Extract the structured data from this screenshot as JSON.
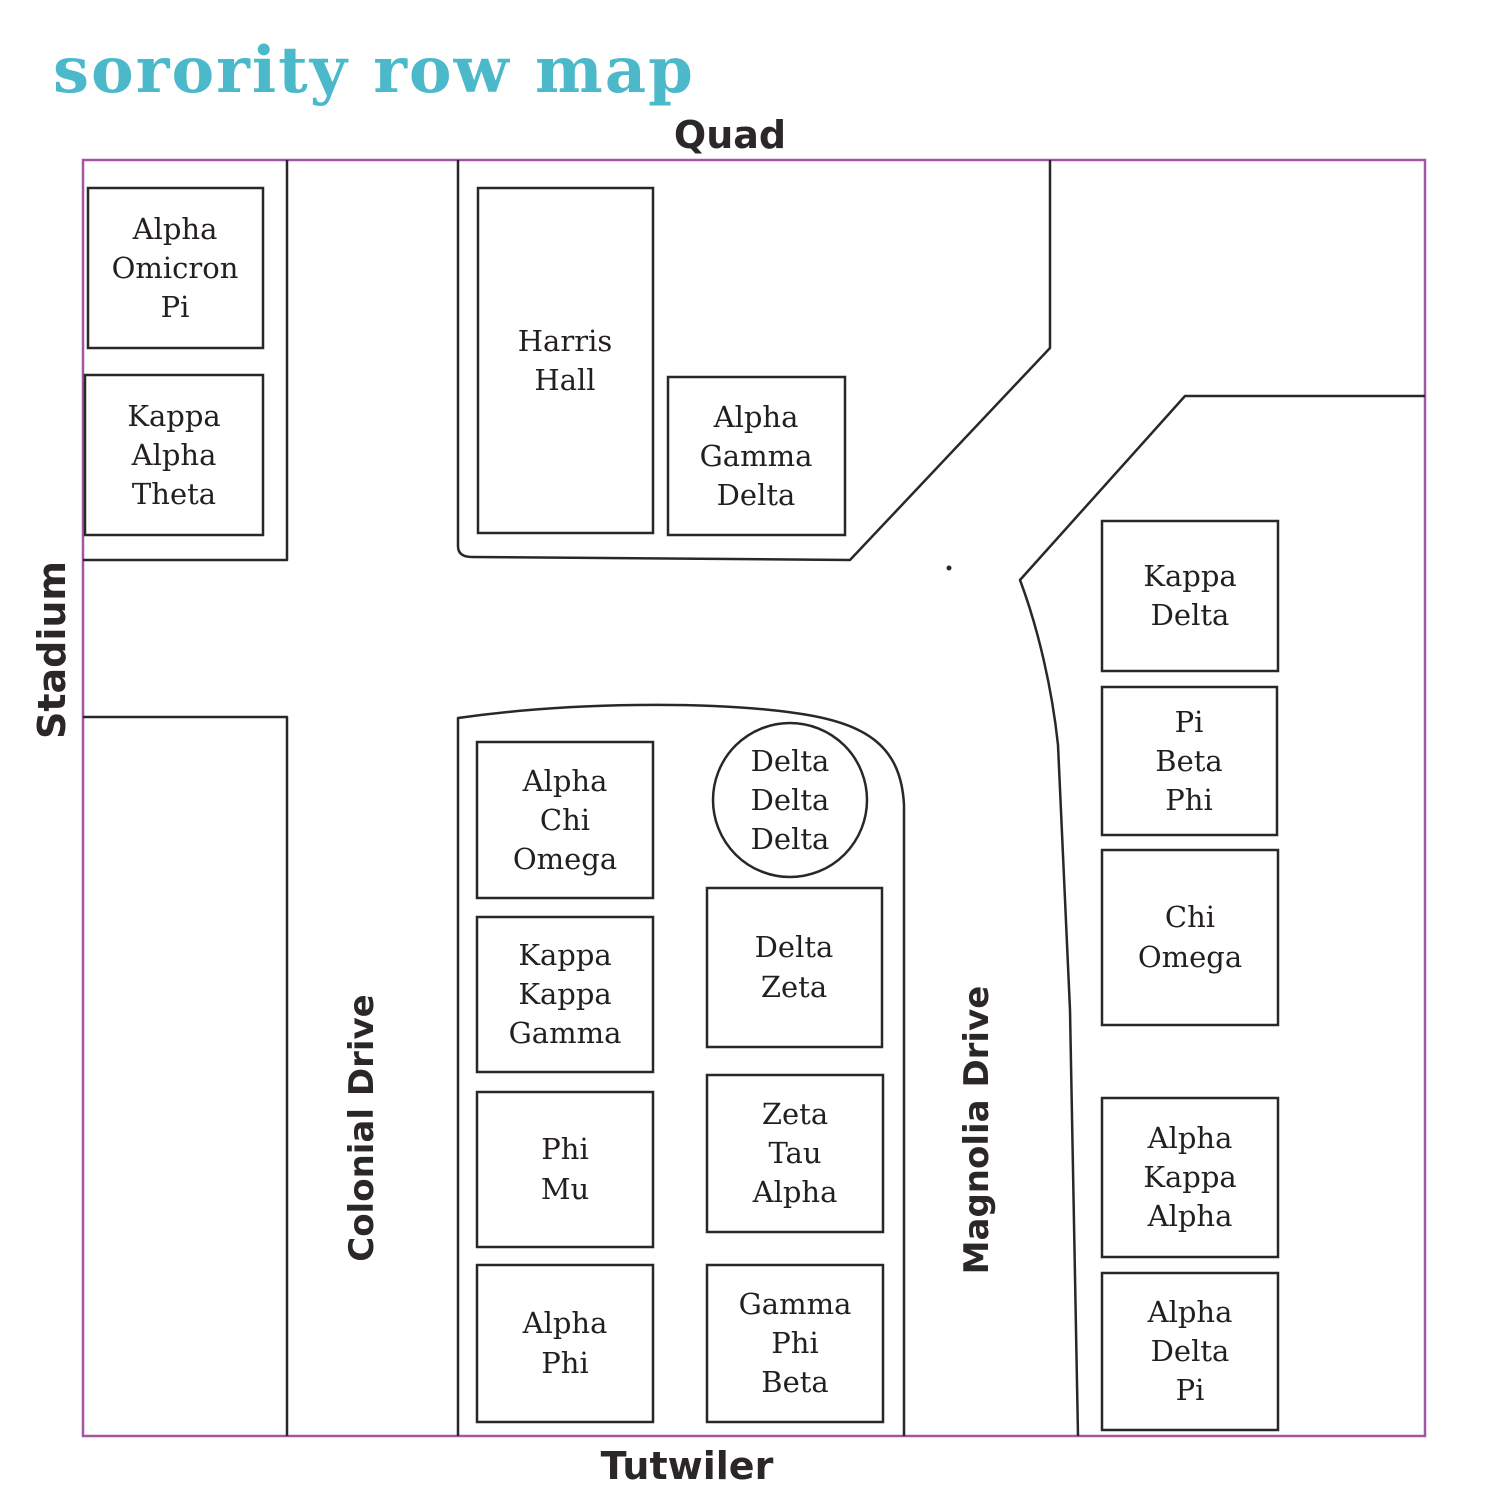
{
  "title": "sorority row map",
  "streets": {
    "quad": "Quad",
    "stadium": "Stadium",
    "colonial_drive": "Colonial Drive",
    "magnolia_drive": "Magnolia Drive",
    "tutwiler": "Tutwiler"
  },
  "buildings": {
    "alpha_omicron_pi": [
      "Alpha",
      "Omicron",
      "Pi"
    ],
    "kappa_alpha_theta": [
      "Kappa",
      "Alpha",
      "Theta"
    ],
    "harris_hall": [
      "Harris",
      "Hall"
    ],
    "alpha_gamma_delta": [
      "Alpha",
      "Gamma",
      "Delta"
    ],
    "kappa_delta": [
      "Kappa",
      "Delta"
    ],
    "pi_beta_phi": [
      "Pi",
      "Beta",
      "Phi"
    ],
    "chi_omega": [
      "Chi",
      "Omega"
    ],
    "alpha_kappa_alpha": [
      "Alpha",
      "Kappa",
      "Alpha"
    ],
    "alpha_delta_pi": [
      "Alpha",
      "Delta",
      "Pi"
    ],
    "alpha_chi_omega": [
      "Alpha",
      "Chi",
      "Omega"
    ],
    "kappa_kappa_gamma": [
      "Kappa",
      "Kappa",
      "Gamma"
    ],
    "phi_mu": [
      "Phi",
      "Mu"
    ],
    "alpha_phi": [
      "Alpha",
      "Phi"
    ],
    "delta_delta_delta": [
      "Delta",
      "Delta",
      "Delta"
    ],
    "delta_zeta": [
      "Delta",
      "Zeta"
    ],
    "zeta_tau_alpha": [
      "Zeta",
      "Tau",
      "Alpha"
    ],
    "gamma_phi_beta": [
      "Gamma",
      "Phi",
      "Beta"
    ]
  },
  "colors": {
    "title": "#4bb9ca",
    "map_border": "#a157a1",
    "lines": "#2b2728",
    "building_text": "#231f20"
  }
}
